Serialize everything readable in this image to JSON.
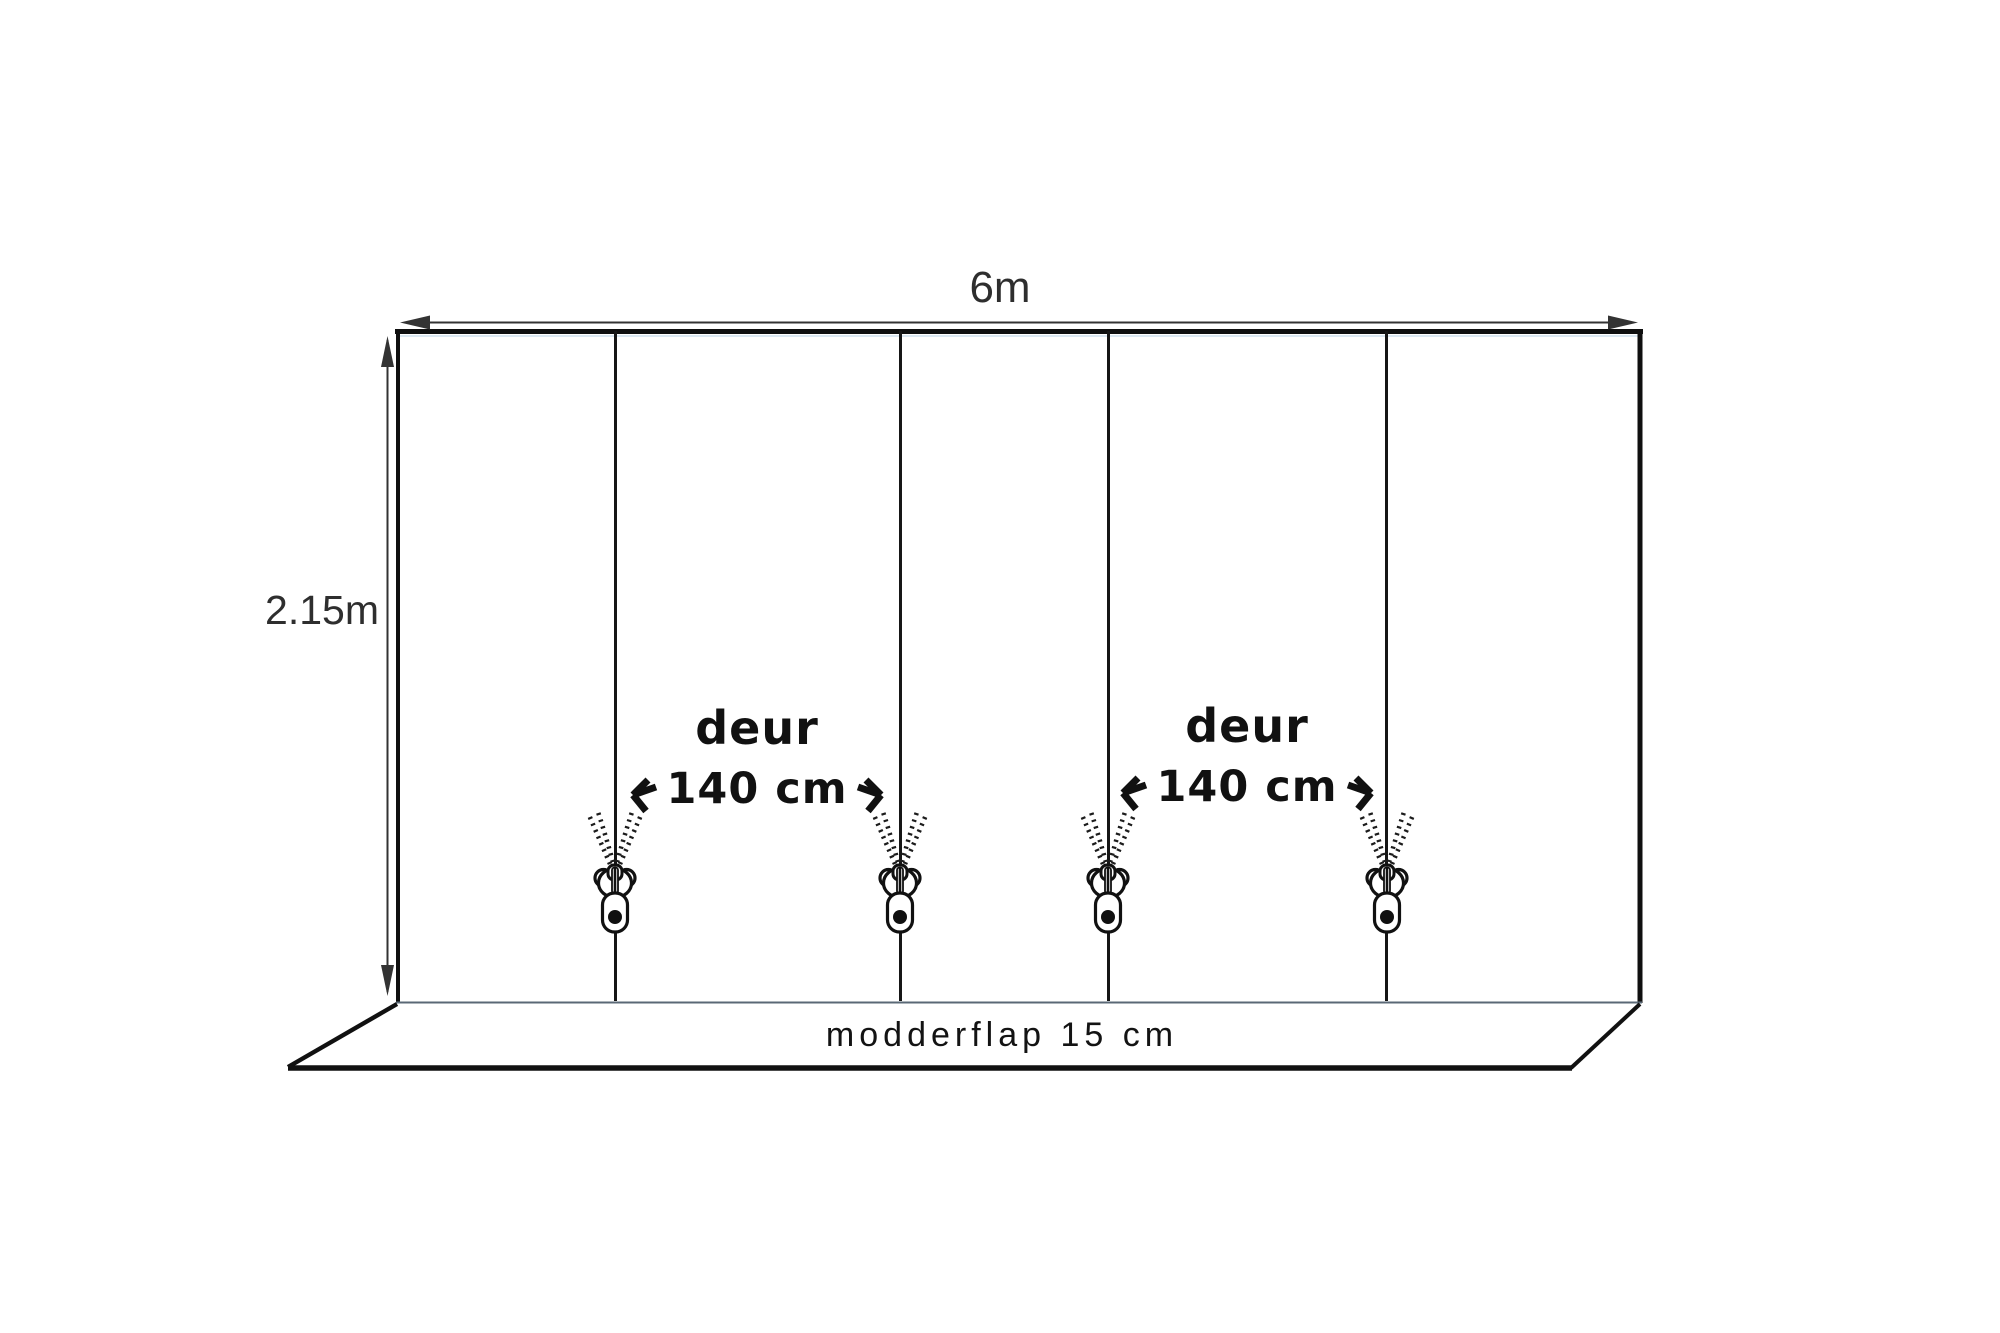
{
  "diagram": {
    "subject": "tent-wall-with-zipper-doors",
    "dimensions": {
      "width_label": "6m",
      "height_label": "2.15m"
    },
    "doors": [
      {
        "label": "deur",
        "width_label": "140 cm"
      },
      {
        "label": "deur",
        "width_label": "140 cm"
      }
    ],
    "mudflap_label": "modderflap 15 cm",
    "zipper_count": 4,
    "colors": {
      "ink": "#141414",
      "dimension_line": "#333333",
      "thin_edge": "#5a6876",
      "accent_blue": "#cfe0ee",
      "background": "#ffffff"
    }
  }
}
